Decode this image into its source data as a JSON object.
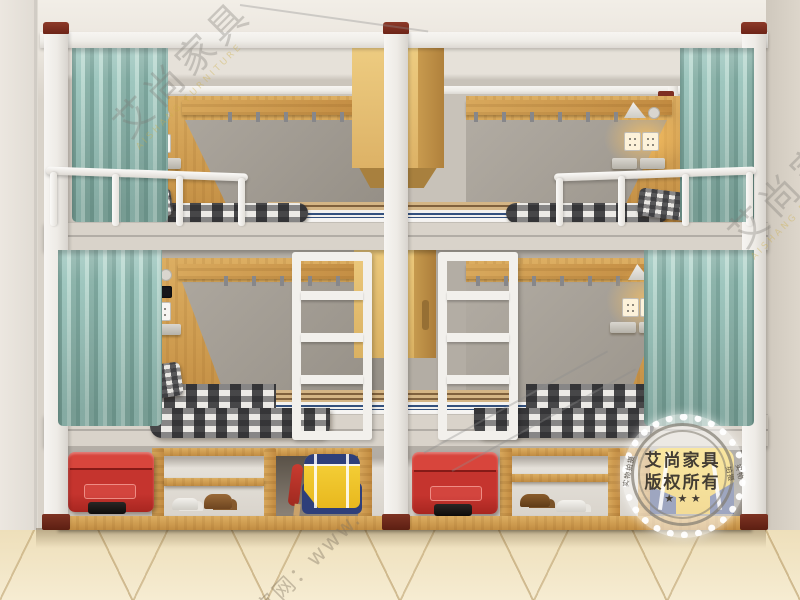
{
  "scene": {
    "description": "3D product photo of two side-by-side white steel double bunk beds (4 berths) with oak headboard panels, gray inset panels, teal privacy curtains, wall reading lamps, power sockets, coat-hook rails, center ladders, hanging wood cabinets, and under-bed storage cubbies holding red suitcases, a yellow duffel bag, a yellow backpack and shoes, on a beige diagonal-tiled floor.",
    "room": "dormitory"
  },
  "palette": {
    "frame_white": "#f2f0ec",
    "wood": "#d3a458",
    "wood_dark": "#b9863f",
    "panel_gray": "#a49e95",
    "wall": "#d9d3ca",
    "ceiling": "#efebe3",
    "floor_tile": "#f2e6c6",
    "curtain_teal": "#9cc3bb",
    "suitcase_red": "#c5342e",
    "bag_yellow": "#f1c427",
    "bag_navy": "#2e3f7a",
    "pillow_orange": "#e2a23c",
    "cap_maroon": "#7e2f23",
    "mattress_stripe_blue": "#34517e"
  },
  "watermarks": {
    "brand_cn": "艾尚家具",
    "brand_en": "AISHANG FURNITURE",
    "website": "官网：www.",
    "stamp": {
      "line1": "艾尚家具",
      "line2": "版权所有",
      "stars": "★ ★ ★",
      "side_left": "实物拍摄",
      "side_right": "实物拍摄"
    }
  }
}
